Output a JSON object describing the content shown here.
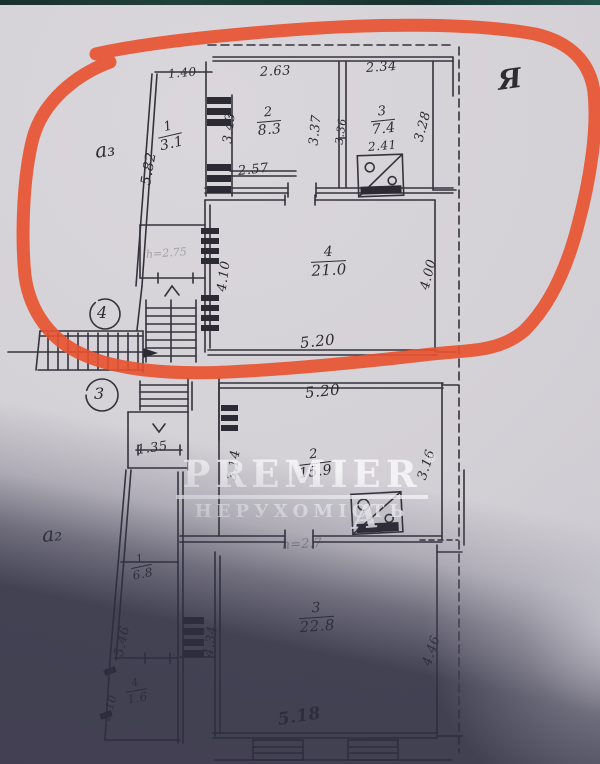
{
  "scene": {
    "description": "Scanned hand-drawn BTI floor plan photo; upper floor circled with red marker",
    "paper_color": "#d6d3d8",
    "shadow_color": "#35344a",
    "ink_color": "#34333c",
    "marker_color": "#e8512e",
    "top_strip_color": "#1d3634"
  },
  "watermark": {
    "brand": "PREMIER",
    "reg_mark": "®",
    "subtitle": "НЕРУХОМІСТЬ",
    "logo_glyph": "А"
  },
  "handwritten": {
    "corner_letter": "Я",
    "wing_upper": "а₃",
    "wing_lower": "а₂",
    "entrance_badge_upper": "4",
    "entrance_badge_lower": "3",
    "height_note_upper": "h=2.75",
    "height_note_lower": "h=2.7"
  },
  "upper_floor": {
    "rooms": {
      "r1": {
        "num": "1",
        "area": "3.1"
      },
      "r2": {
        "num": "2",
        "area": "8.3"
      },
      "r3": {
        "num": "3",
        "area": "7.4"
      },
      "r4": {
        "num": "4",
        "area": "21.0"
      }
    },
    "dims": {
      "top_left": "1.40",
      "top_mid": "2.63",
      "top_right": "2.34",
      "slant_left": "5.82",
      "r2_left": "3.43",
      "r2_right": "3.37",
      "r3_left": "3.36",
      "r3_right": "3.28",
      "stove_width": "2.41",
      "passage": "2.57",
      "r4_left": "4.10",
      "r4_right": "4.00",
      "r4_bottom": "5.20"
    }
  },
  "lower_floor": {
    "rooms": {
      "r2": {
        "num": "2",
        "area": "15.9"
      },
      "r3": {
        "num": "3",
        "area": "22.8"
      },
      "r1": {
        "num": "1",
        "area": "6.8"
      },
      "r4": {
        "num": "4",
        "area": "1.6"
      }
    },
    "dims": {
      "top": "5.20",
      "r2_left": "3.14",
      "r2_right": "3.16",
      "landing": "1.35",
      "slant_left": "5.46",
      "r3_left": "4.34",
      "r3_right": "4.46",
      "r3_bottom": "5.18",
      "small_left": "2.10"
    }
  }
}
